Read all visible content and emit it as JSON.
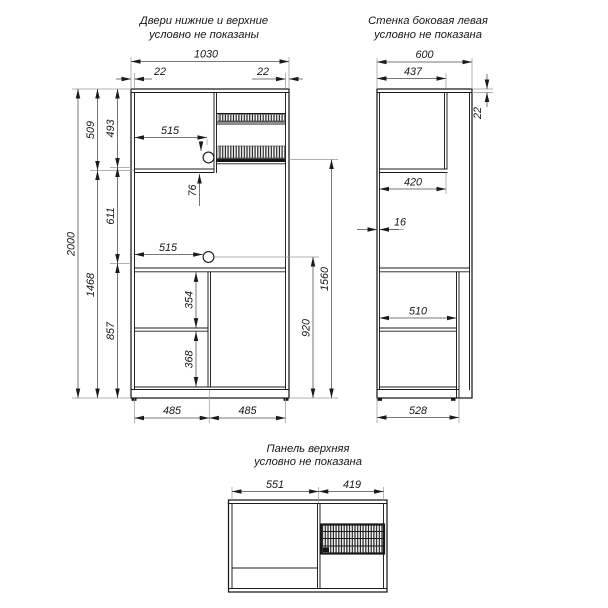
{
  "notes": {
    "front_line1": "Двери нижние и верхние",
    "front_line2": "условно не показаны",
    "side_line1": "Стенка боковая левая",
    "side_line2": "условно не показана",
    "top_line1": "Панель верхняя",
    "top_line2": "условно не показана"
  },
  "front": {
    "total_width": "1030",
    "wall_left": "22",
    "wall_right": "22",
    "total_height": "2000",
    "upper_section": "509",
    "lower_section": "1468",
    "inner_493": "493",
    "inner_611": "611",
    "inner_857": "857",
    "shelf_top_515": "515",
    "hole_offset_76": "76",
    "shelf_mid_515": "515",
    "inner_354": "354",
    "inner_368": "368",
    "right_920": "920",
    "right_1560": "1560",
    "bottom_485_left": "485",
    "bottom_485_right": "485"
  },
  "side": {
    "total_depth": "600",
    "niche_437": "437",
    "panel_22": "22",
    "inner_420": "420",
    "wall_16": "16",
    "shelf_510": "510",
    "bottom_528": "528"
  },
  "top": {
    "left_551": "551",
    "right_419": "419"
  },
  "colors": {
    "line": "#1b1b1b",
    "background": "#ffffff"
  }
}
